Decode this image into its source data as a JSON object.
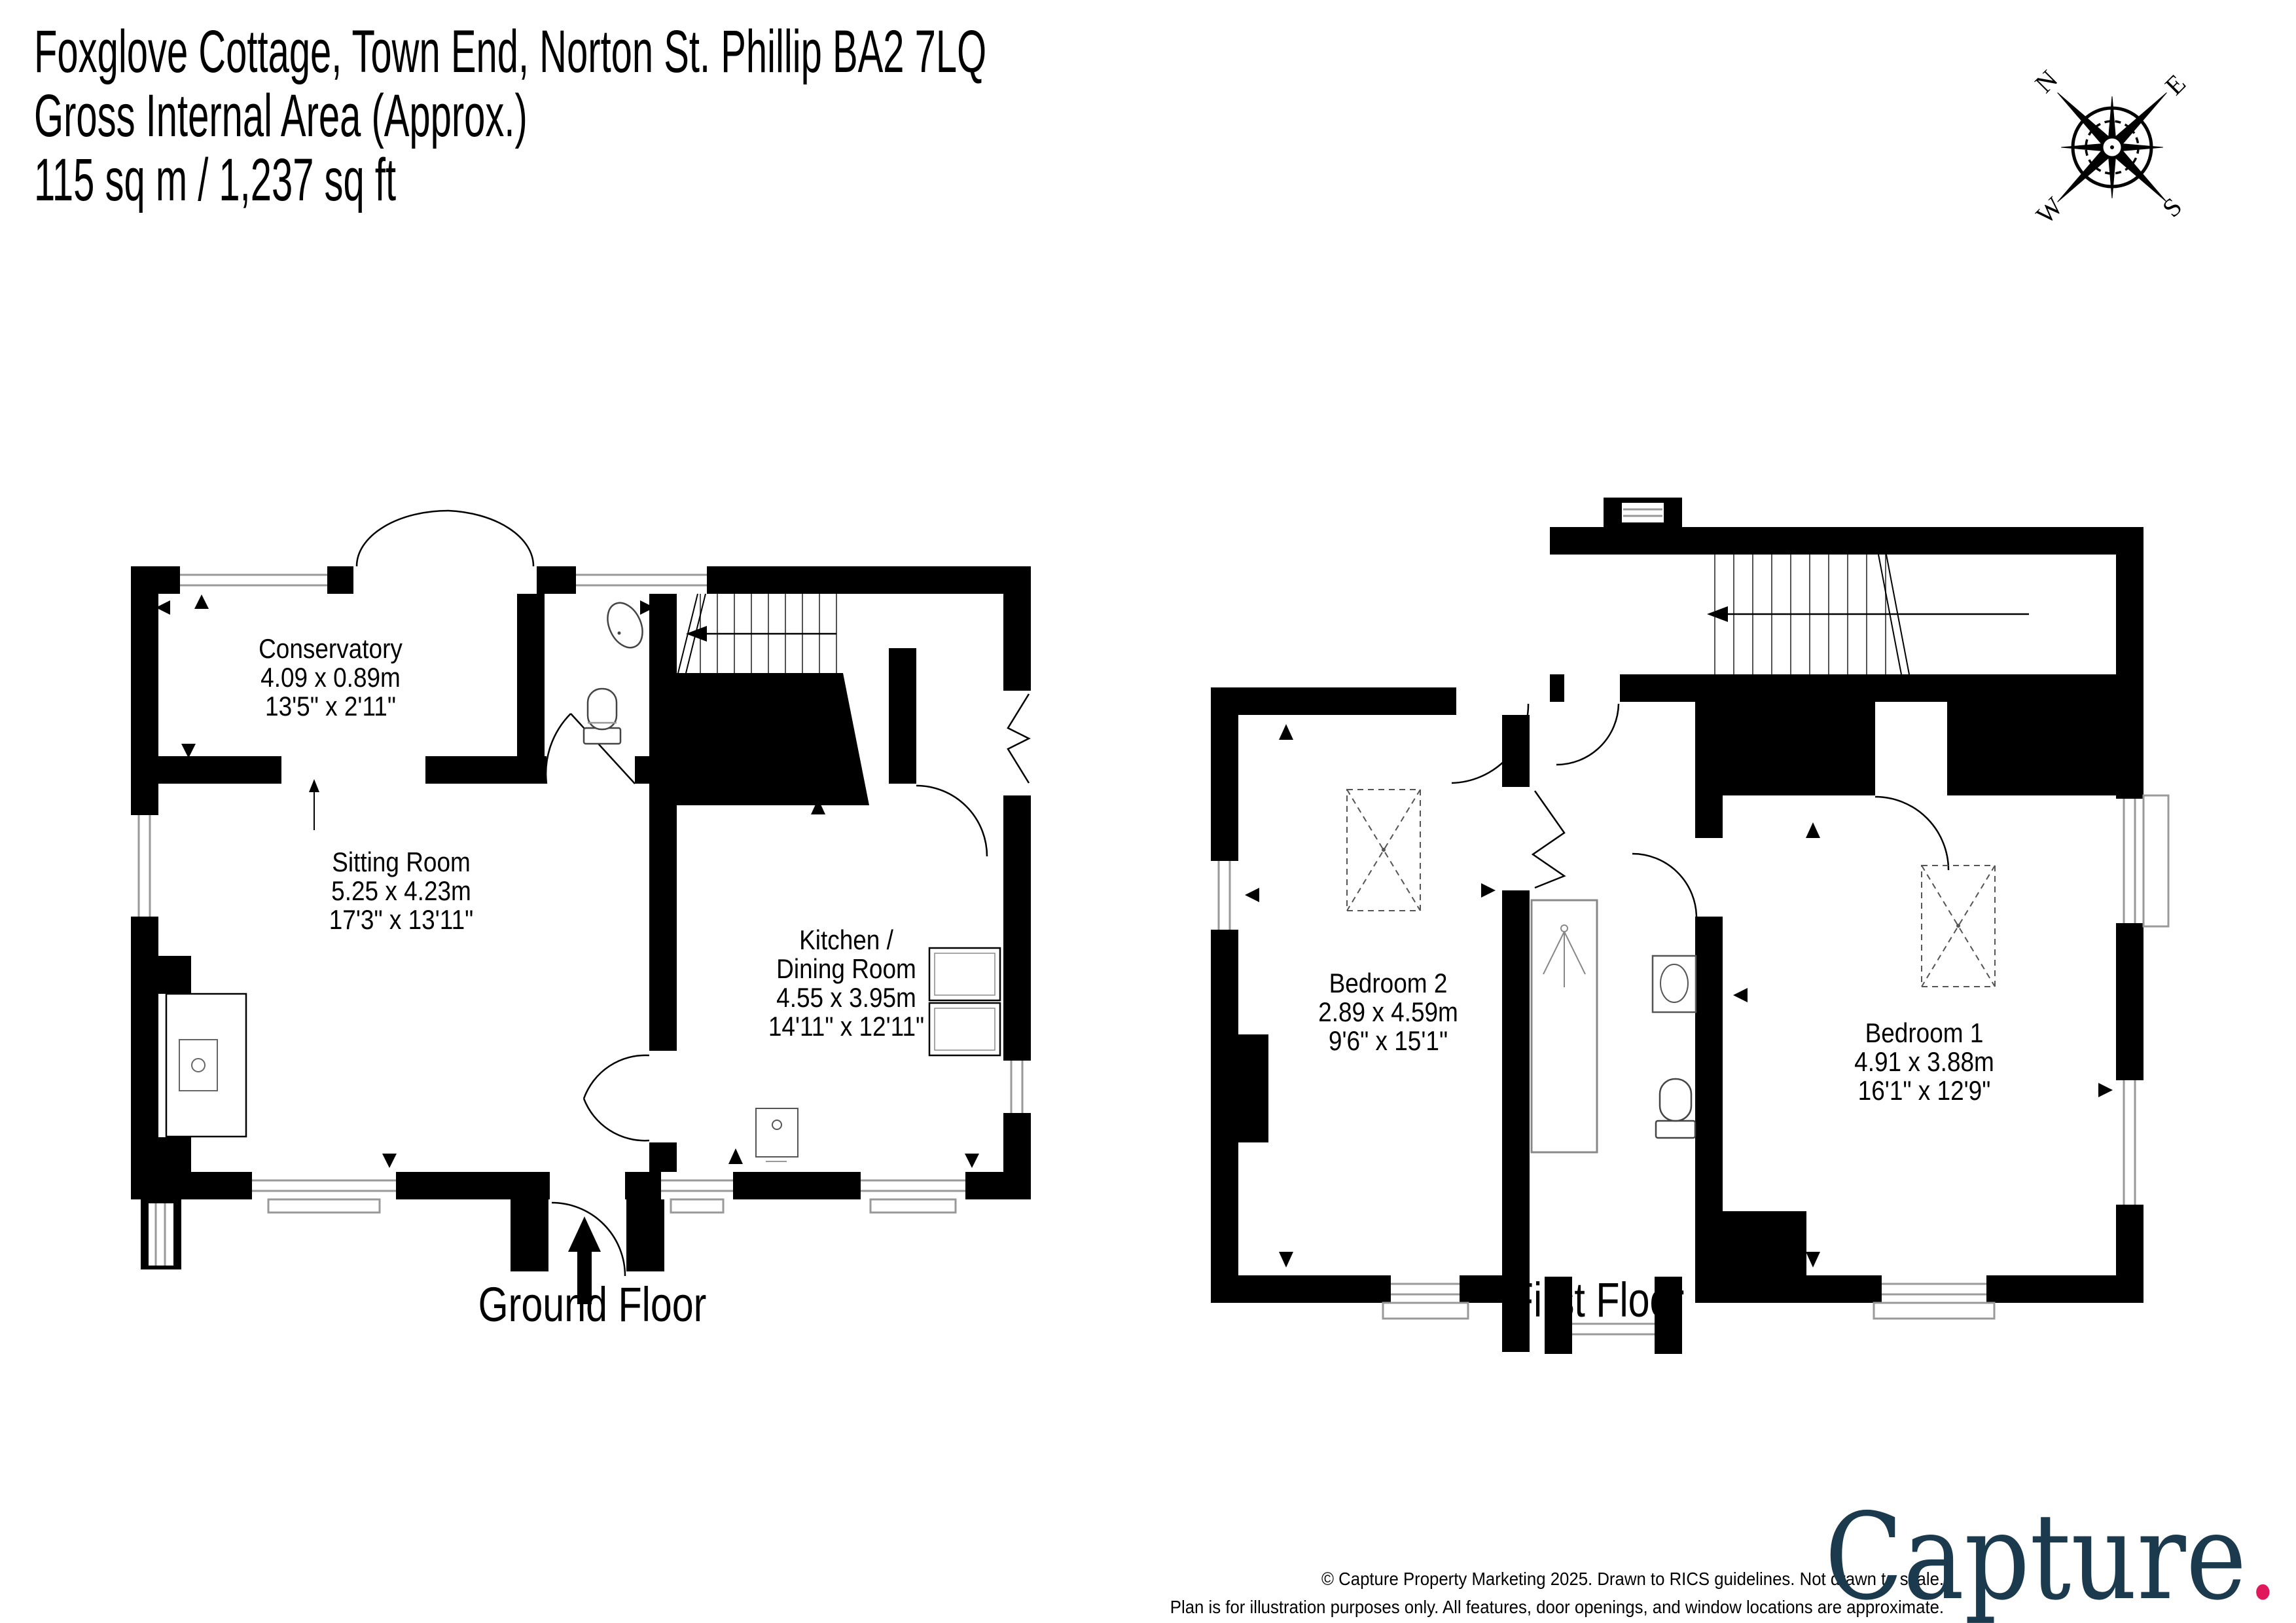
{
  "header": {
    "line1": "Foxglove Cottage, Town End, Norton St. Phillip  BA2 7LQ",
    "line2": "Gross Internal Area (Approx.)",
    "line3": "115 sq m /  1,237 sq ft"
  },
  "compass": {
    "n": "N",
    "e": "E",
    "s": "S",
    "w": "W"
  },
  "ground_floor": {
    "label": "Ground Floor",
    "rooms": {
      "conservatory": {
        "name": "Conservatory",
        "metric": "4.09 x 0.89m",
        "imperial": "13'5\" x 2'11\""
      },
      "sitting_room": {
        "name": "Sitting Room",
        "metric": "5.25 x 4.23m",
        "imperial": "17'3\" x 13'11\""
      },
      "kitchen": {
        "name_line1": "Kitchen /",
        "name_line2": "Dining Room",
        "metric": "4.55 x 3.95m",
        "imperial": "14'11\" x 12'11\""
      }
    }
  },
  "first_floor": {
    "label": "First Floor",
    "rooms": {
      "bedroom2": {
        "name": "Bedroom 2",
        "metric": "2.89 x 4.59m",
        "imperial": "9'6\" x 15'1\""
      },
      "bedroom1": {
        "name": "Bedroom 1",
        "metric": "4.91 x 3.88m",
        "imperial": "16'1\" x 12'9\""
      }
    }
  },
  "footer": {
    "line1": "© Capture Property Marketing 2025. Drawn to RICS guidelines.  Not drawn to scale.",
    "line2": "Plan is for illustration purposes only. All features, door openings, and window locations are approximate.",
    "line3": "All measurements and areas are approximate and should not be relied on as a statement of fact.",
    "logo_text": "Capture",
    "logo_dot": ".",
    "logo_color": "#1c3a4d",
    "logo_dot_color": "#e0195d",
    "wall_color": "#000000"
  }
}
